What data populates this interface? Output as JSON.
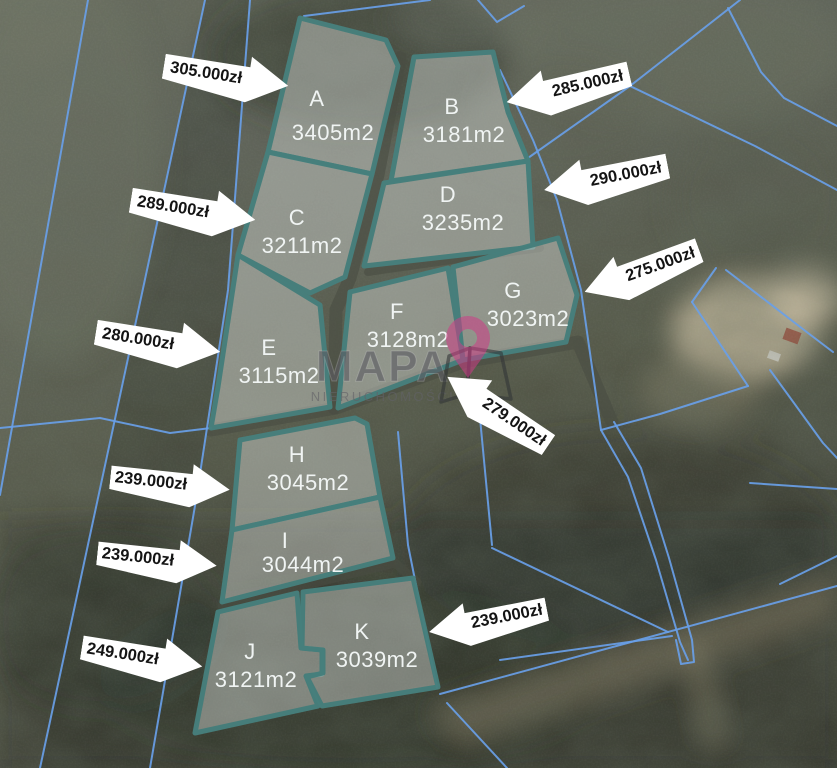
{
  "watermark": {
    "title": "MAPA",
    "subtitle": "NIERUCHOMOŚCI"
  },
  "colors": {
    "plot_outline": "#47807d",
    "plot_fill": "rgba(208,213,210,0.48)",
    "cadastral_line": "#699fe8",
    "plot_label_text": "#f0f4f3",
    "arrow_background": "#ffffff",
    "arrow_text": "#141414",
    "watermark_pin": "rgba(205,60,135,0.55)"
  },
  "plots": [
    {
      "label": "A",
      "area": "3405m2",
      "polygon": "300,18 386,40 398,66 372,174 268,152",
      "lx": 317,
      "ly": 106,
      "ax": 333,
      "ay": 140
    },
    {
      "label": "B",
      "area": "3181m2",
      "polygon": "414,57 493,52 508,112 528,161 391,181",
      "lx": 452,
      "ly": 114,
      "ax": 464,
      "ay": 142
    },
    {
      "label": "C",
      "area": "3211m2",
      "polygon": "268,152 372,174 345,277 310,293 238,255",
      "lx": 297,
      "ly": 225,
      "ax": 302,
      "ay": 253
    },
    {
      "label": "D",
      "area": "3235m2",
      "polygon": "384,183 528,161 533,247 364,266",
      "lx": 448,
      "ly": 202,
      "ax": 463,
      "ay": 230
    },
    {
      "label": "E",
      "area": "3115m2",
      "polygon": "238,255 320,305 330,407 211,428 218,387",
      "lx": 269,
      "ly": 355,
      "ax": 279,
      "ay": 383
    },
    {
      "label": "F",
      "area": "3128m2",
      "polygon": "350,292 448,268 463,360 338,408",
      "lx": 397,
      "ly": 319,
      "ax": 408,
      "ay": 347
    },
    {
      "label": "G",
      "area": "3023m2",
      "polygon": "453,267 558,238 577,295 566,342 463,360",
      "lx": 513,
      "ly": 298,
      "ax": 528,
      "ay": 326
    },
    {
      "label": "H",
      "area": "3045m2",
      "polygon": "240,440 355,418 367,424 380,497 232,530",
      "lx": 297,
      "ly": 462,
      "ax": 308,
      "ay": 490
    },
    {
      "label": "I",
      "area": "3044m2",
      "polygon": "232,530 380,497 393,558 222,602",
      "lx": 285,
      "ly": 548,
      "ax": 303,
      "ay": 572
    },
    {
      "label": "J",
      "area": "3121m2",
      "polygon": "218,612 297,593 301,648 322,650 322,674 306,676 318,706 195,733",
      "lx": 250,
      "ly": 659,
      "ax": 256,
      "ay": 687
    },
    {
      "label": "K",
      "area": "3039m2",
      "polygon": "303,592 413,578 438,687 322,706 307,677 323,673 323,650 302,648",
      "lx": 362,
      "ly": 639,
      "ax": 377,
      "ay": 667
    }
  ],
  "price_arrows": [
    {
      "text": "305.000zł",
      "x": 163,
      "y": 52,
      "w": 126,
      "h": 48,
      "rot": 9,
      "dir": "right"
    },
    {
      "text": "285.000zł",
      "x": 505,
      "y": 64,
      "w": 126,
      "h": 48,
      "rot": -13,
      "dir": "left"
    },
    {
      "text": "290.000zł",
      "x": 543,
      "y": 154,
      "w": 126,
      "h": 48,
      "rot": -11,
      "dir": "left"
    },
    {
      "text": "275.000zł",
      "x": 581,
      "y": 247,
      "w": 122,
      "h": 48,
      "rot": -20,
      "dir": "left"
    },
    {
      "text": "289.000zł",
      "x": 130,
      "y": 186,
      "w": 126,
      "h": 48,
      "rot": 9,
      "dir": "right"
    },
    {
      "text": "280.000zł",
      "x": 95,
      "y": 318,
      "w": 126,
      "h": 48,
      "rot": 9,
      "dir": "right"
    },
    {
      "text": "279.000zł",
      "x": 437,
      "y": 388,
      "w": 122,
      "h": 46,
      "rot": 34,
      "dir": "left"
    },
    {
      "text": "239.000zł",
      "x": 110,
      "y": 461,
      "w": 120,
      "h": 45,
      "rot": 6,
      "dir": "right"
    },
    {
      "text": "239.000zł",
      "x": 97,
      "y": 537,
      "w": 120,
      "h": 45,
      "rot": 6,
      "dir": "right"
    },
    {
      "text": "249.000zł",
      "x": 81,
      "y": 634,
      "w": 122,
      "h": 46,
      "rot": 9,
      "dir": "right"
    },
    {
      "text": "239.000zł",
      "x": 428,
      "y": 598,
      "w": 120,
      "h": 45,
      "rot": -11,
      "dir": "left"
    }
  ],
  "cadastral_lines": [
    [
      88,
      0,
      0,
      495
    ],
    [
      205,
      0,
      40,
      768
    ],
    [
      250,
      0,
      228,
      290,
      196,
      500,
      150,
      768
    ],
    [
      304,
      16,
      430,
      0
    ],
    [
      478,
      0,
      497,
      22,
      524,
      6
    ],
    [
      740,
      0,
      630,
      86,
      528,
      158
    ],
    [
      630,
      86,
      755,
      146,
      837,
      190
    ],
    [
      728,
      8,
      761,
      72,
      784,
      98,
      837,
      126
    ],
    [
      500,
      70,
      533,
      140,
      557,
      200,
      581,
      290,
      601,
      430
    ],
    [
      601,
      430,
      628,
      477,
      656,
      560,
      680,
      642,
      688,
      660
    ],
    [
      614,
      422,
      641,
      468,
      669,
      558,
      692,
      640,
      694,
      662,
      681,
      664,
      676,
      640
    ],
    [
      492,
      548,
      668,
      632
    ],
    [
      500,
      660,
      672,
      636
    ],
    [
      750,
      483,
      837,
      489
    ],
    [
      780,
      584,
      837,
      556
    ],
    [
      692,
      302,
      748,
      386
    ],
    [
      748,
      386,
      660,
      414,
      601,
      430
    ],
    [
      716,
      268,
      692,
      302
    ],
    [
      726,
      270,
      808,
      333,
      833,
      352
    ],
    [
      770,
      370,
      823,
      443,
      837,
      458
    ],
    [
      480,
      418,
      492,
      545
    ],
    [
      398,
      432,
      408,
      545,
      415,
      580,
      437,
      688
    ],
    [
      440,
      694,
      837,
      586
    ],
    [
      447,
      703,
      507,
      768
    ],
    [
      0,
      428,
      100,
      418,
      170,
      433,
      211,
      428
    ]
  ],
  "roads": [
    {
      "pts": [
        400,
        58,
        378,
        175,
        350,
        278,
        336,
        310,
        334,
        408
      ],
      "w": 13
    },
    {
      "pts": [
        211,
        430,
        336,
        408,
        463,
        362,
        578,
        342,
        612,
        422
      ],
      "w": 13
    },
    {
      "pts": [
        368,
        272,
        452,
        260,
        540,
        248
      ],
      "w": 8
    },
    {
      "pts": [
        222,
        606,
        395,
        563,
        417,
        582
      ],
      "w": 9
    }
  ]
}
